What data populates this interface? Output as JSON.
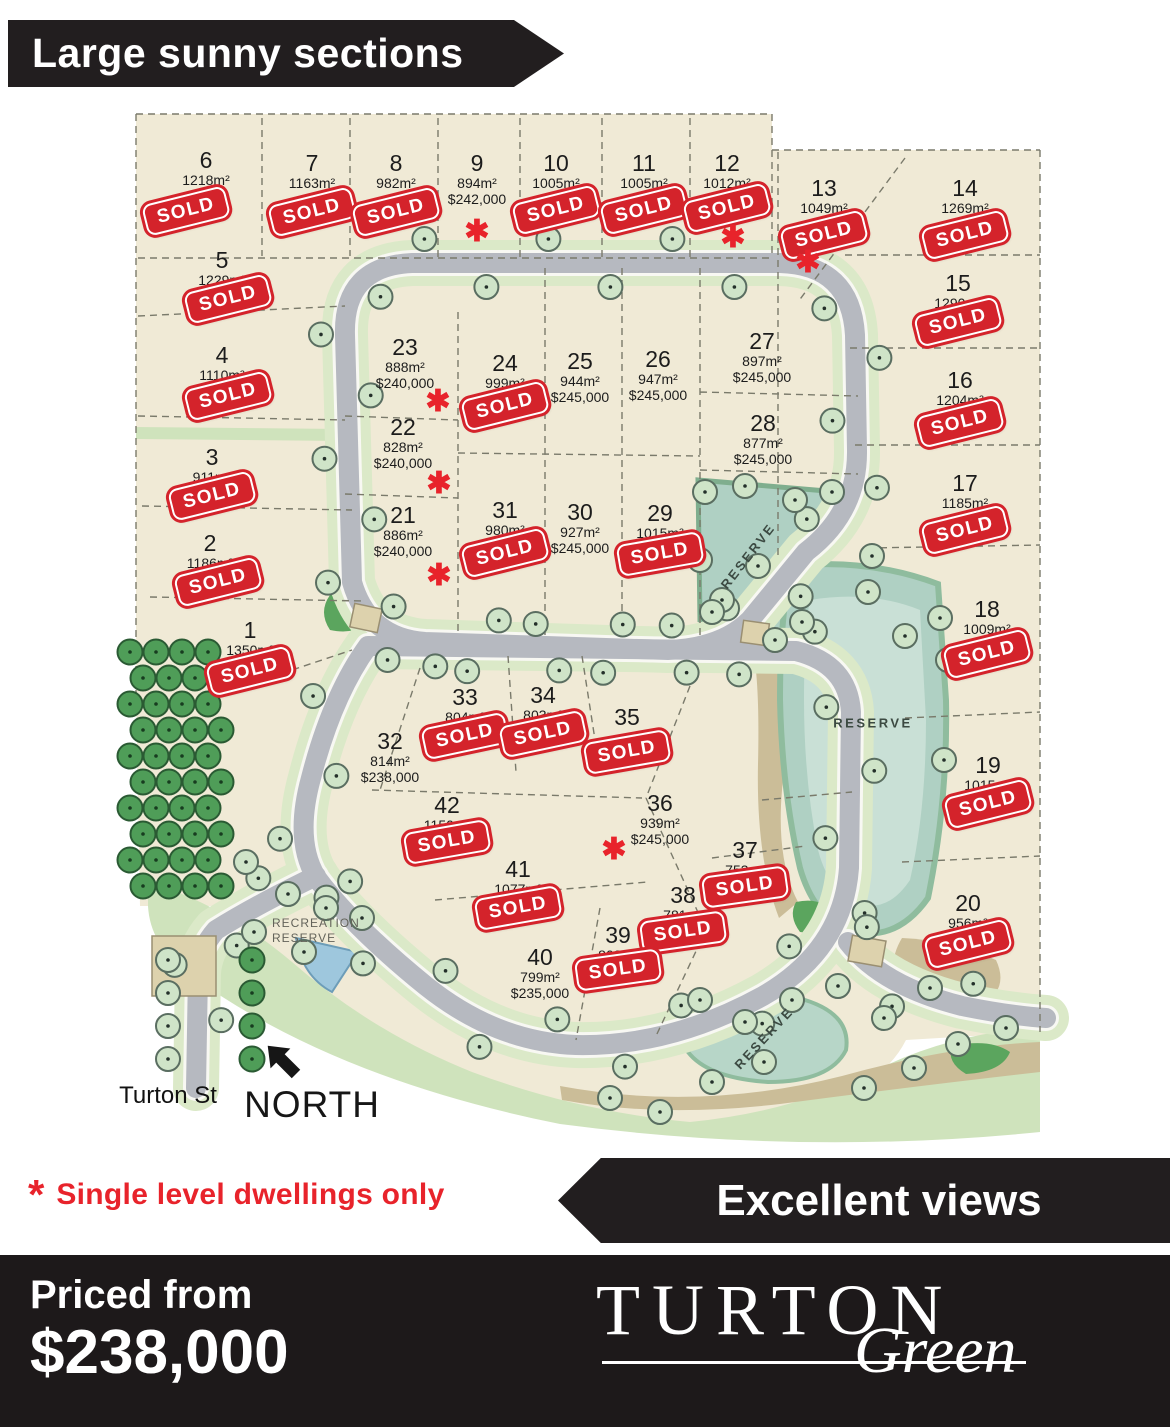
{
  "banner_top": {
    "label": "Large sunny sections"
  },
  "banner_views": {
    "label": "Excellent views"
  },
  "note": {
    "symbol": "*",
    "text": "Single level dwellings only"
  },
  "footer": {
    "priced_from": "Priced from",
    "price": "$238,000",
    "brand": "TURTON",
    "brand_sub": "Green"
  },
  "map": {
    "north": "NORTH",
    "street": "Turton St",
    "recreation_line1": "RECREATION",
    "recreation_line2": "RESERVE",
    "sold_text": "SOLD",
    "star_symbol": "✱",
    "reserves": [
      {
        "label": "RESERVE",
        "x": 748,
        "y": 556,
        "rot": -52
      },
      {
        "label": "RESERVE",
        "x": 873,
        "y": 723,
        "rot": 0
      },
      {
        "label": "RESERVE",
        "x": 764,
        "y": 1038,
        "rot": -47
      }
    ],
    "lots": [
      {
        "n": "1",
        "size": "1350m²",
        "sold": true,
        "x": 250,
        "y": 633,
        "sdy": 38
      },
      {
        "n": "2",
        "size": "1186m²",
        "sold": true,
        "x": 210,
        "y": 546,
        "sdx": 8,
        "sdy": 36
      },
      {
        "n": "3",
        "size": "911m²",
        "sold": true,
        "x": 212,
        "y": 460,
        "sdy": 36
      },
      {
        "n": "4",
        "size": "1110m²",
        "sold": true,
        "x": 222,
        "y": 358,
        "sdx": 6,
        "sdy": 38
      },
      {
        "n": "5",
        "size": "1229m²",
        "sold": true,
        "x": 222,
        "y": 263,
        "sdx": 6,
        "sdy": 36
      },
      {
        "n": "6",
        "size": "1218m²",
        "sold": true,
        "x": 206,
        "y": 163,
        "sdx": -20,
        "sdy": 48
      },
      {
        "n": "7",
        "size": "1163m²",
        "sold": true,
        "x": 312,
        "y": 166,
        "sdy": 46
      },
      {
        "n": "8",
        "size": "982m²",
        "sold": true,
        "x": 396,
        "y": 166,
        "sdy": 46
      },
      {
        "n": "9",
        "size": "894m²",
        "price": "$242,000",
        "x": 477,
        "y": 166,
        "star": true,
        "star_dx": 0,
        "star_dy": 66
      },
      {
        "n": "10",
        "size": "1005m²",
        "sold": true,
        "x": 556,
        "y": 166,
        "sdy": 44
      },
      {
        "n": "11",
        "size": "1005m²",
        "sold": true,
        "x": 644,
        "y": 166,
        "sdy": 44
      },
      {
        "n": "12",
        "size": "1012m²",
        "sold": true,
        "x": 727,
        "y": 166,
        "sdy": 42,
        "star": true,
        "star_dx": 6,
        "star_dy": 72
      },
      {
        "n": "13",
        "size": "1049m²",
        "sold": true,
        "x": 824,
        "y": 191,
        "sdy": 44,
        "star": true,
        "star_dx": -16,
        "star_dy": 72
      },
      {
        "n": "14",
        "size": "1269m²",
        "sold": true,
        "x": 965,
        "y": 191,
        "sdy": 44
      },
      {
        "n": "15",
        "size": "1290m²",
        "sold": true,
        "x": 958,
        "y": 286,
        "sdy": 36
      },
      {
        "n": "16",
        "size": "1204m²",
        "sold": true,
        "x": 960,
        "y": 383,
        "sdy": 40
      },
      {
        "n": "17",
        "size": "1185m²",
        "sold": true,
        "x": 965,
        "y": 486,
        "sdy": 44
      },
      {
        "n": "18",
        "size": "1009m²",
        "sold": true,
        "x": 987,
        "y": 612,
        "sdy": 42
      },
      {
        "n": "19",
        "size": "1015m²",
        "sold": true,
        "x": 988,
        "y": 768,
        "sdy": 36
      },
      {
        "n": "20",
        "size": "956m²",
        "sold": true,
        "x": 968,
        "y": 906,
        "sdy": 38
      },
      {
        "n": "21",
        "size": "886m²",
        "price": "$240,000",
        "x": 403,
        "y": 518,
        "star": true,
        "star_dx": 36,
        "star_dy": 58
      },
      {
        "n": "22",
        "size": "828m²",
        "price": "$240,000",
        "x": 403,
        "y": 430,
        "star": true,
        "star_dx": 36,
        "star_dy": 54
      },
      {
        "n": "23",
        "size": "888m²",
        "price": "$240,000",
        "x": 405,
        "y": 350,
        "star": true,
        "star_dx": 33,
        "star_dy": 52
      },
      {
        "n": "24",
        "size": "999m²",
        "sold": true,
        "x": 505,
        "y": 366,
        "sdy": 40
      },
      {
        "n": "25",
        "size": "944m²",
        "price": "$245,000",
        "x": 580,
        "y": 364
      },
      {
        "n": "26",
        "size": "947m²",
        "price": "$245,000",
        "x": 658,
        "y": 362
      },
      {
        "n": "27",
        "size": "897m²",
        "price": "$245,000",
        "x": 762,
        "y": 344
      },
      {
        "n": "28",
        "size": "877m²",
        "price": "$245,000",
        "x": 763,
        "y": 426
      },
      {
        "n": "29",
        "size": "1015m²",
        "sold": true,
        "x": 660,
        "y": 516,
        "sdy": 38,
        "rot": -10
      },
      {
        "n": "30",
        "size": "927m²",
        "price": "$245,000",
        "x": 580,
        "y": 515
      },
      {
        "n": "31",
        "size": "980m²",
        "sold": true,
        "x": 505,
        "y": 513,
        "sdy": 40
      },
      {
        "n": "32",
        "size": "814m²",
        "price": "$238,000",
        "x": 390,
        "y": 744
      },
      {
        "n": "33",
        "size": "804m²",
        "sold": true,
        "x": 465,
        "y": 700,
        "sdy": 36,
        "rot": -12
      },
      {
        "n": "34",
        "size": "803m²",
        "sold": true,
        "x": 543,
        "y": 698,
        "sdy": 36,
        "rot": -12
      },
      {
        "n": "35",
        "size": "",
        "sold": true,
        "x": 627,
        "y": 720,
        "sdy": 32,
        "rot": -10
      },
      {
        "n": "36",
        "size": "939m²",
        "price": "$245,000",
        "x": 660,
        "y": 806,
        "star": true,
        "star_dx": -46,
        "star_dy": 44
      },
      {
        "n": "37",
        "size": "753m²",
        "sold": true,
        "x": 745,
        "y": 853,
        "sdy": 34,
        "rot": -8
      },
      {
        "n": "38",
        "size": "781m²",
        "sold": true,
        "x": 683,
        "y": 898,
        "sdy": 34,
        "rot": -8
      },
      {
        "n": "39",
        "size": "802m²",
        "sold": true,
        "x": 618,
        "y": 938,
        "sdy": 32,
        "rot": -8
      },
      {
        "n": "40",
        "size": "799m²",
        "price": "$235,000",
        "x": 540,
        "y": 960
      },
      {
        "n": "41",
        "size": "1077m²",
        "sold": true,
        "x": 518,
        "y": 872,
        "sdy": 36,
        "rot": -10
      },
      {
        "n": "42",
        "size": "1150m²",
        "sold": true,
        "x": 447,
        "y": 808,
        "sdy": 34,
        "rot": -10
      }
    ]
  }
}
